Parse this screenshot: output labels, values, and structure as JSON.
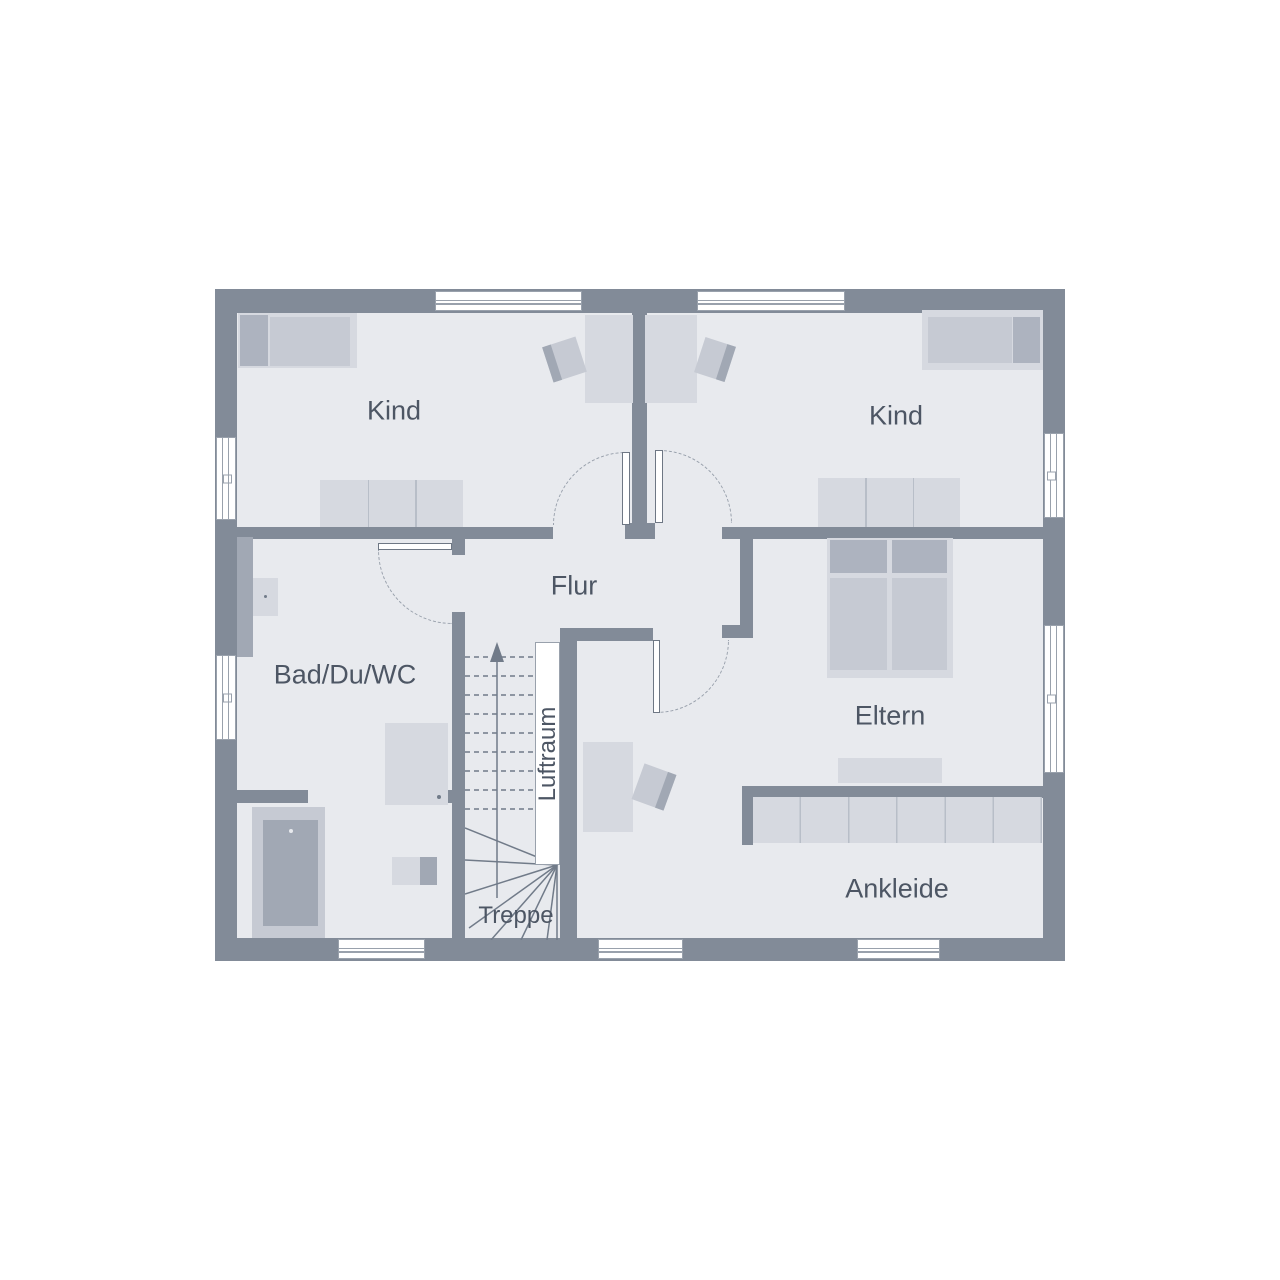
{
  "floorplan": {
    "type": "floor-plan",
    "rooms": {
      "kind_left": "Kind",
      "kind_right": "Kind",
      "flur": "Flur",
      "bad": "Bad/Du/WC",
      "eltern": "Eltern",
      "ankleide": "Ankleide",
      "treppe": "Treppe",
      "luftraum": "Luftraum"
    },
    "colors": {
      "wall": "#828b98",
      "floor": "#e8eaee",
      "line": "#99a1ac",
      "furn_light": "#d6d9e0",
      "furn_med": "#c6cad3",
      "furn_dark": "#a1a8b4",
      "furn_line": "#b8bec8",
      "pillow": "#adb3bf",
      "text": "#4d5664",
      "leaf_line": "#6e7784",
      "stair_line": "#717b89"
    }
  }
}
